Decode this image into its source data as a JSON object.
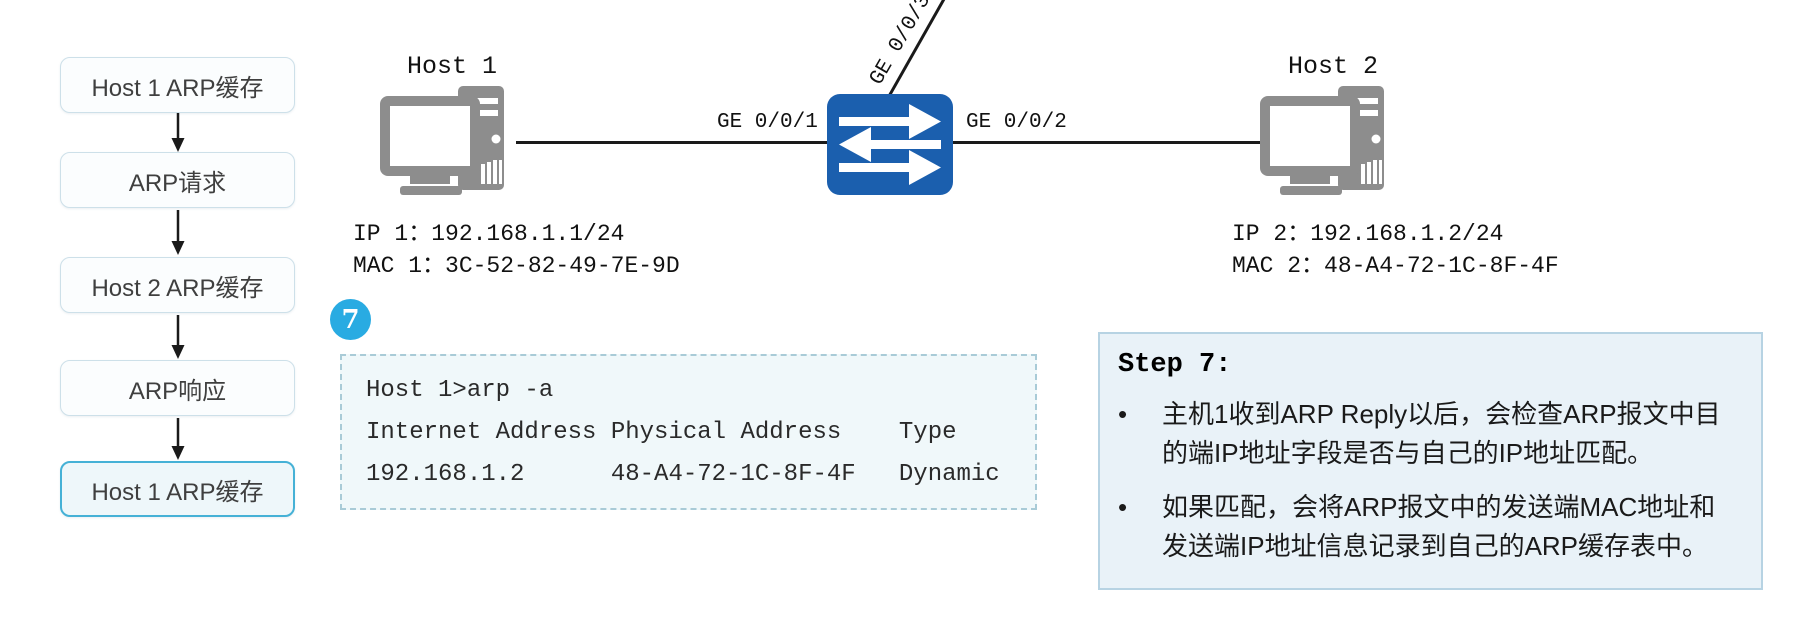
{
  "flowchart": {
    "nodes": [
      {
        "label": "Host 1 ARP缓存",
        "highlighted": false
      },
      {
        "label": "ARP请求",
        "highlighted": false
      },
      {
        "label": "Host 2 ARP缓存",
        "highlighted": false
      },
      {
        "label": "ARP响应",
        "highlighted": false
      },
      {
        "label": "Host 1 ARP缓存",
        "highlighted": true
      }
    ]
  },
  "topology": {
    "host1": {
      "name": "Host 1",
      "ip_label": "IP 1：192.168.1.1/24",
      "mac_label": "MAC 1：3C-52-82-49-7E-9D"
    },
    "host2": {
      "name": "Host 2",
      "ip_label": "IP 2：192.168.1.2/24",
      "mac_label": "MAC 2：48-A4-72-1C-8F-4F"
    },
    "switch_ports": {
      "left": "GE 0/0/1",
      "right": "GE 0/0/2",
      "uplink": "GE 0/0/3"
    }
  },
  "step_marker": "7",
  "console": {
    "lines": [
      "Host 1>arp -a",
      "Internet Address Physical Address    Type",
      "192.168.1.2      48-A4-72-1C-8F-4F   Dynamic"
    ]
  },
  "step_panel": {
    "title": "Step 7:",
    "bullet_glyph": "•",
    "bullets": [
      "主机1收到ARP Reply以后，会检查ARP报文中目的端IP地址字段是否与自己的IP地址匹配。",
      "如果匹配，会将ARP报文中的发送端MAC地址和发送端IP地址信息记录到自己的ARP缓存表中。"
    ]
  },
  "colors": {
    "switch_blue": "#1b5fae",
    "badge_blue": "#29abe2",
    "highlight_border": "#45b1d6",
    "box_border": "#cde0e9",
    "console_bg": "#f0f8fa",
    "console_border": "#a9cbd7",
    "panel_bg": "#e9f2f8",
    "panel_border": "#b7d3e3",
    "host_gray": "#8d8d8d"
  }
}
